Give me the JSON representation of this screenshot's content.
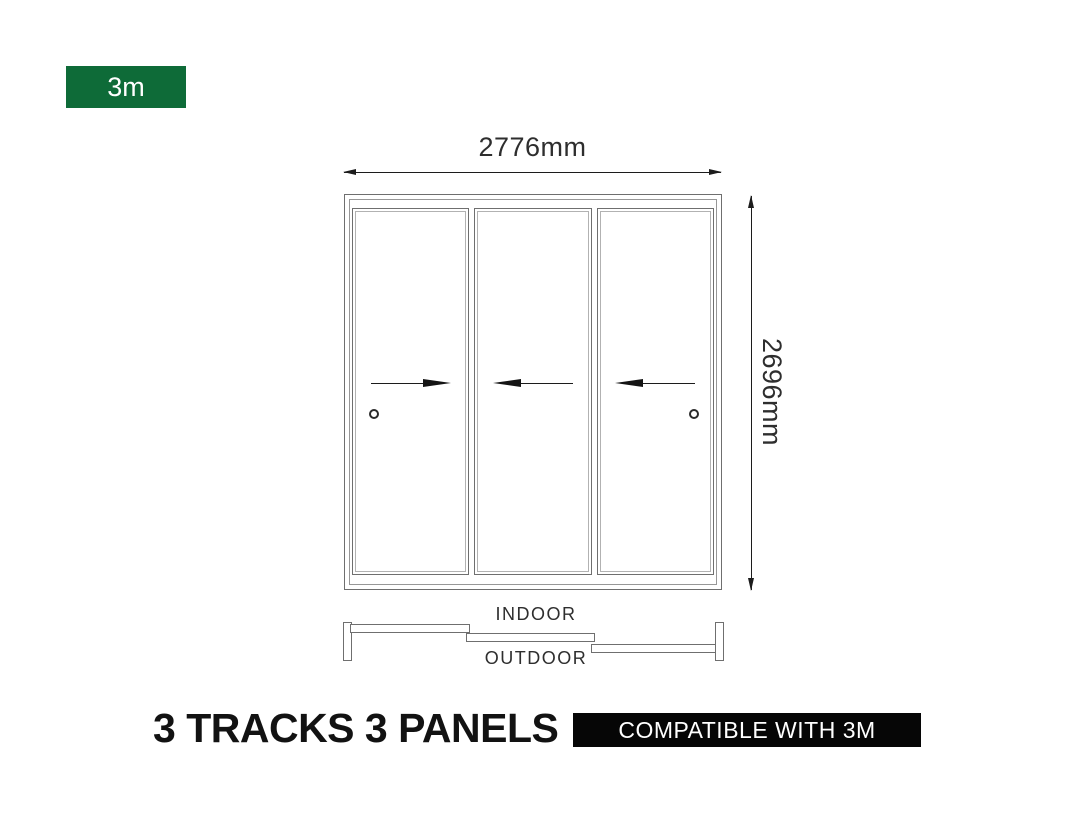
{
  "colors": {
    "accent_green": "#0E6B38",
    "badge_black": "#060606",
    "frame_line_gray": "#6f6f6f",
    "dimension_line_black": "#1c1c1c"
  },
  "size_badge": {
    "label": "3m"
  },
  "diagram": {
    "width_dim": {
      "label": "2776mm"
    },
    "height_dim": {
      "label": "2696mm"
    },
    "tracks_count": 3,
    "panels_count": 3,
    "panels": [
      {
        "id": "panel-1",
        "slide_direction": "right",
        "handle_position": "left"
      },
      {
        "id": "panel-2",
        "slide_direction": "left",
        "handle_position": null
      },
      {
        "id": "panel-3",
        "slide_direction": "left",
        "handle_position": "right"
      }
    ],
    "plan": {
      "indoor_label": "INDOOR",
      "outdoor_label": "OUTDOOR"
    }
  },
  "footer": {
    "title": "3 TRACKS 3 PANELS",
    "badge": {
      "label": "COMPATIBLE WITH 3M"
    }
  }
}
